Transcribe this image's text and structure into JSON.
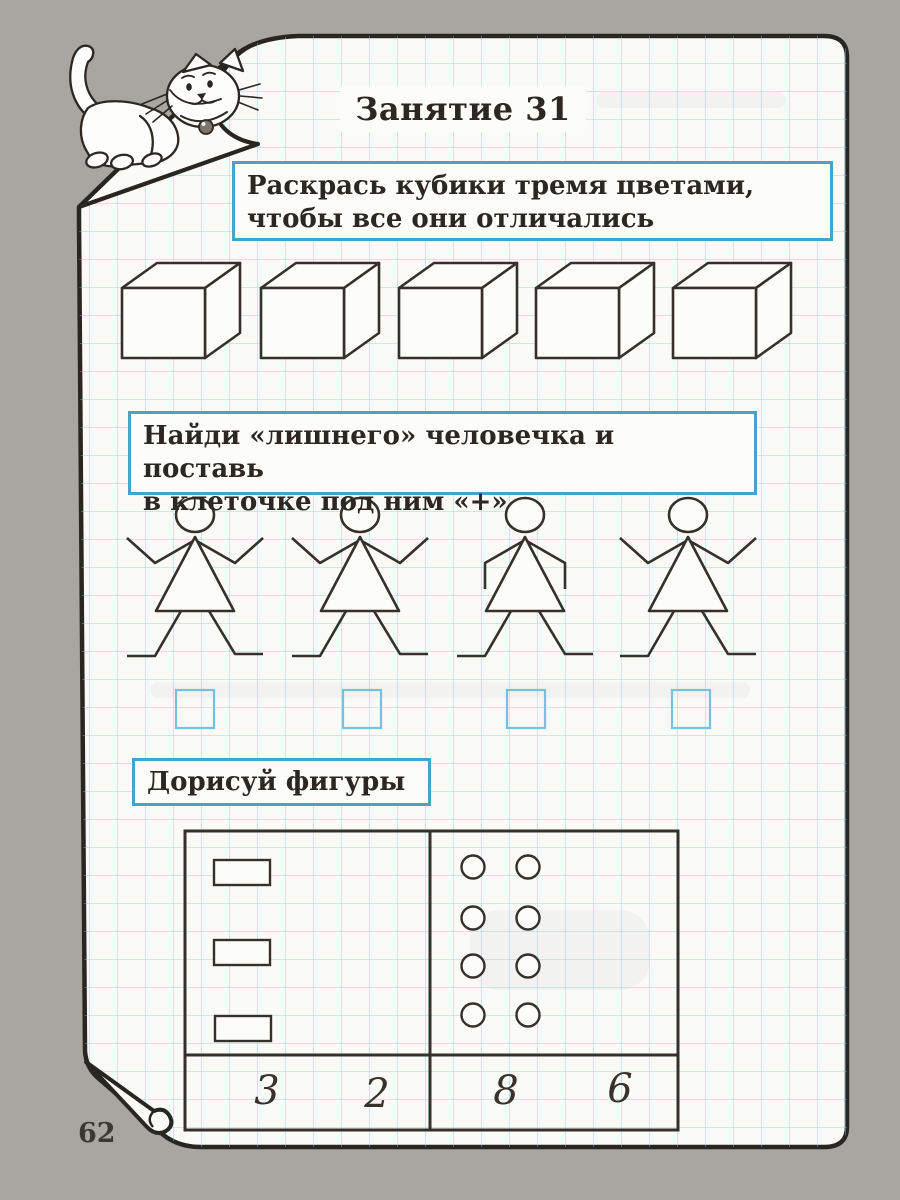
{
  "page": {
    "title": "Занятие 31",
    "number": "62"
  },
  "tasks": {
    "cubes": {
      "instruction_lines": [
        "Раскрась кубики тремя цветами,",
        "чтобы все они отличались"
      ],
      "cube_count": 5
    },
    "odd_one_out": {
      "instruction_lines": [
        "Найди «лишнего» человечка и поставь",
        "в клеточке под ним «+»"
      ],
      "figure_count": 4,
      "figures": [
        {
          "pose": "arms-up"
        },
        {
          "pose": "arms-up"
        },
        {
          "pose": "arms-down"
        },
        {
          "pose": "arms-up"
        }
      ],
      "answer_box_count": 4
    },
    "complete_shapes": {
      "instruction": "Дорисуй фигуры",
      "table": {
        "left_cell_shape": "rectangle",
        "left_cell_count": 3,
        "right_cell_shape": "circle",
        "right_cell_count": 8,
        "bottom_numbers": [
          "3",
          "2",
          "8",
          "6"
        ]
      }
    }
  },
  "decor": {
    "cat": "white cartoon cat with collar and bell standing on the curled page corner",
    "paper_color": "#fafaf6",
    "grid_color": "#83cee8",
    "accent_border_color": "#4aa2cb",
    "ink_color": "#2c2722",
    "background_color": "#a9a6a2"
  }
}
